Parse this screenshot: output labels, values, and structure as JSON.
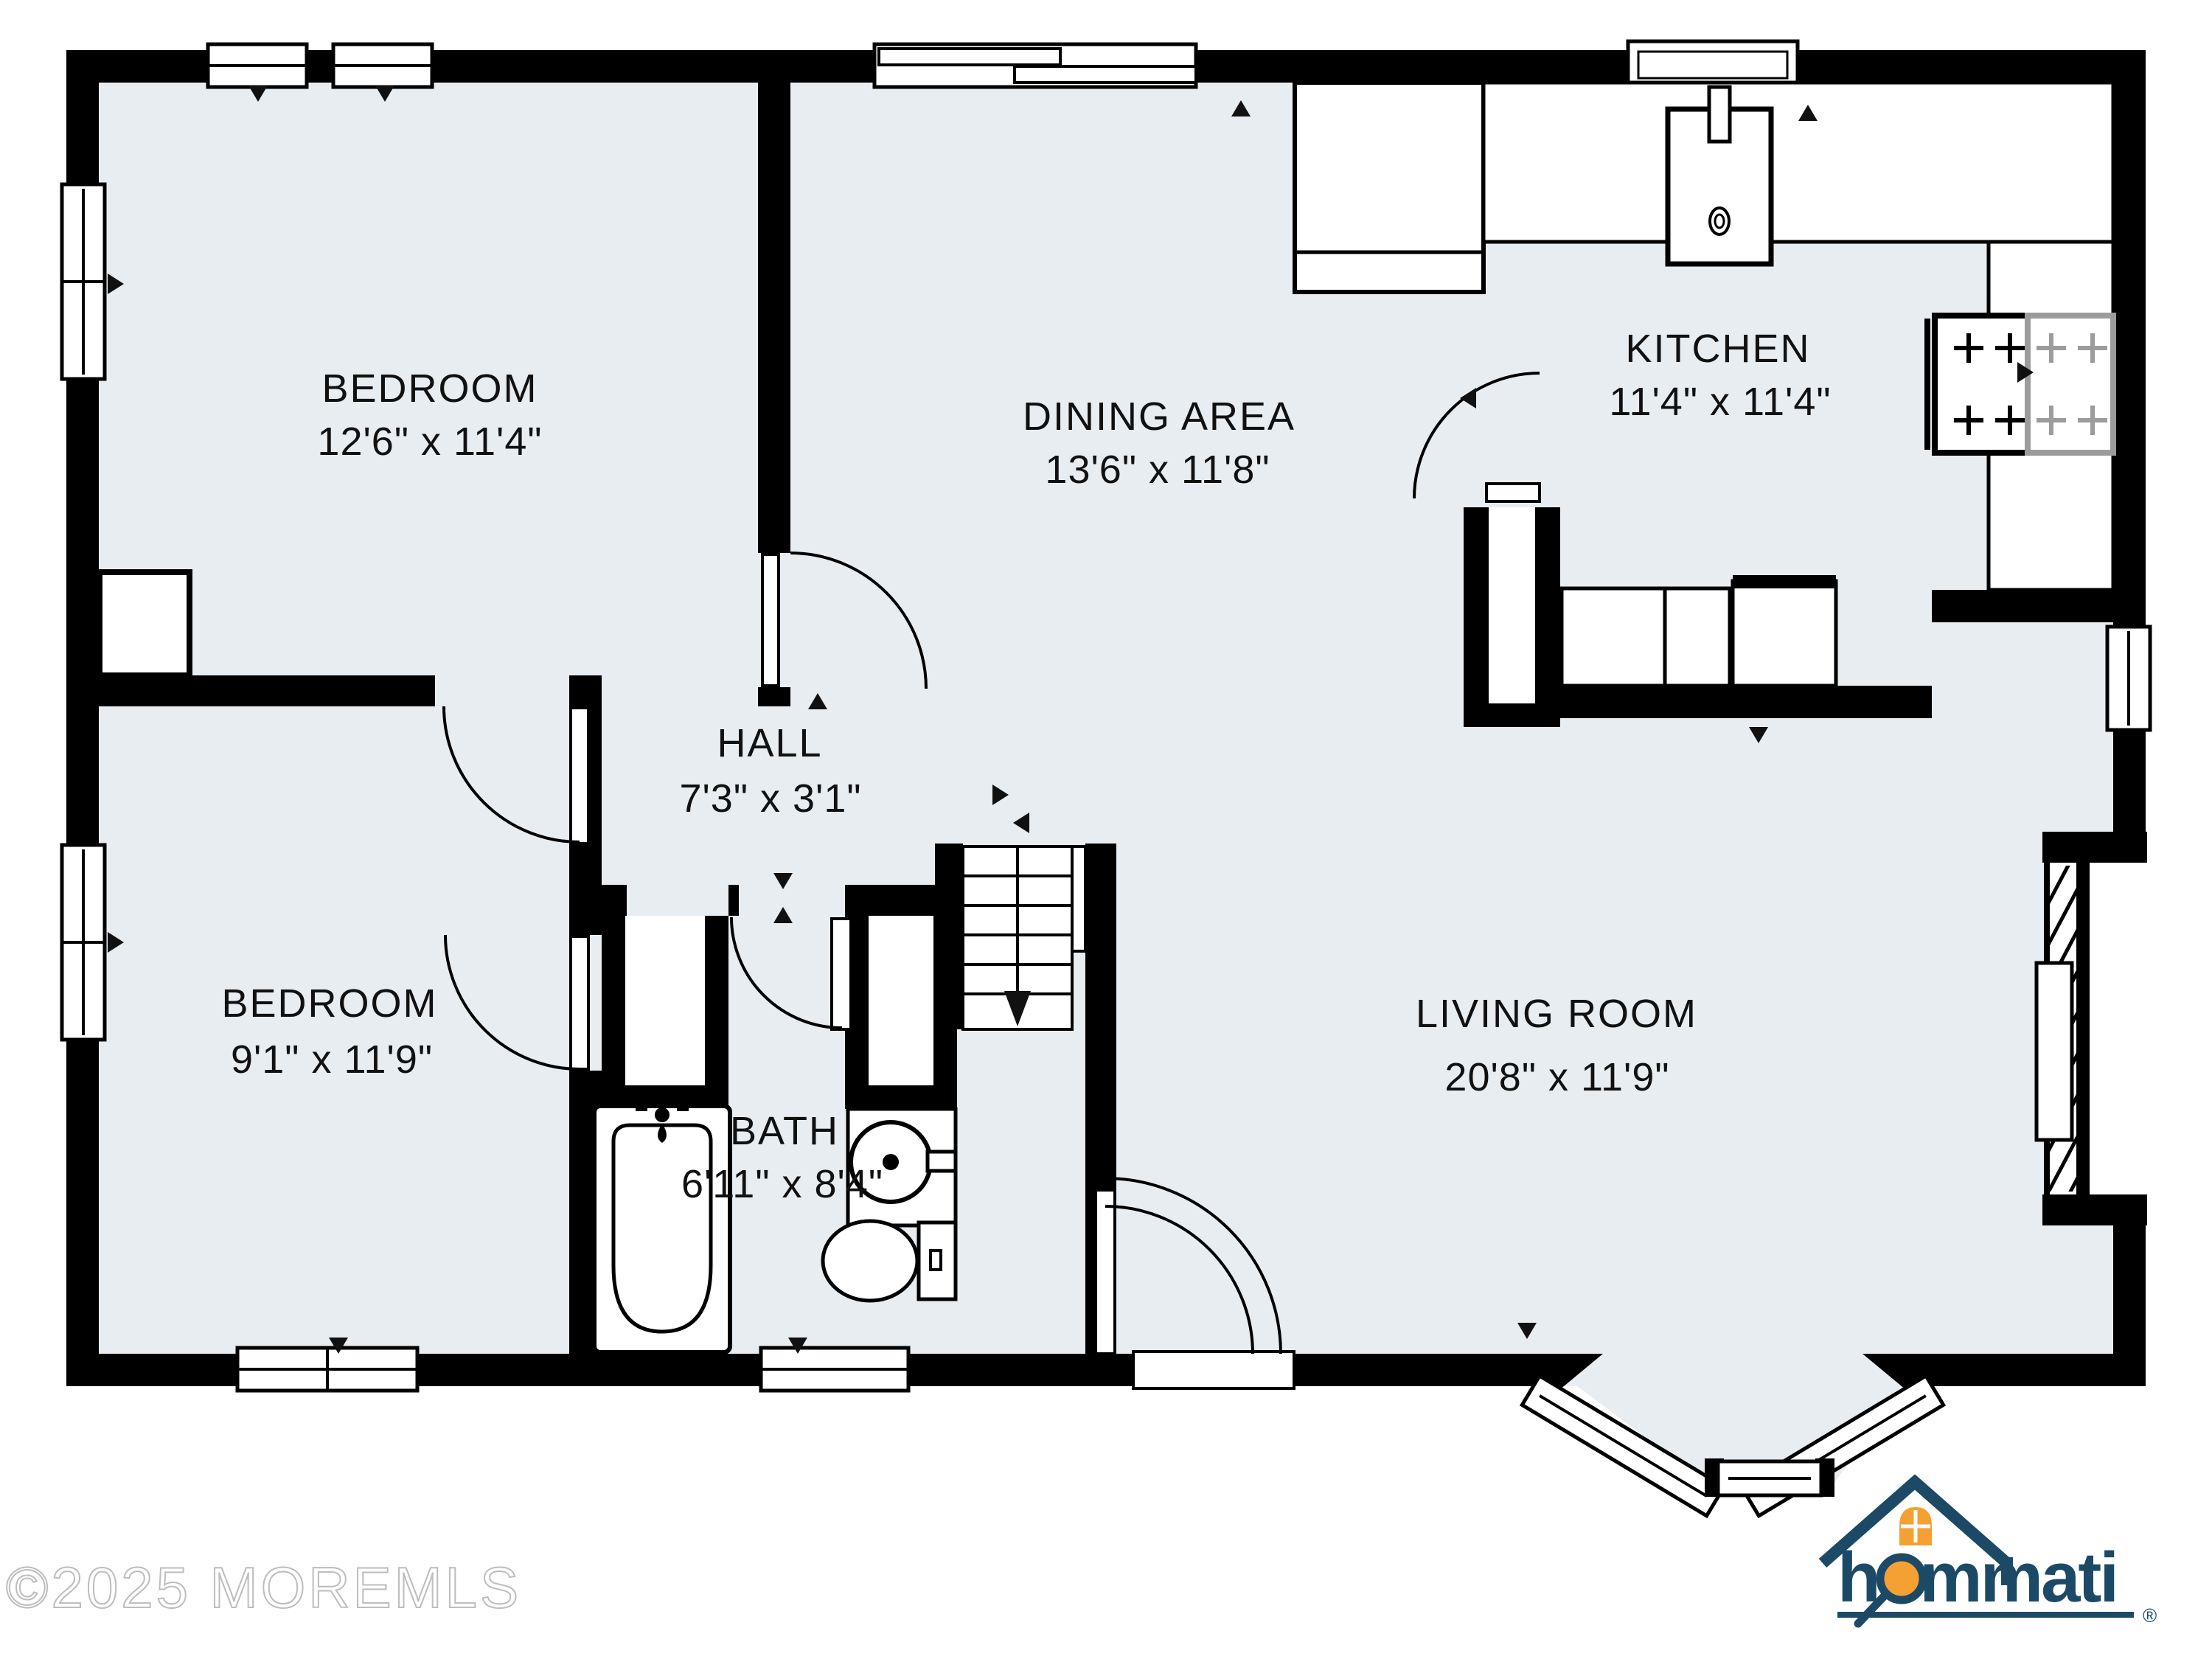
{
  "colors": {
    "floor": "#e8edf1",
    "wall": "#000000",
    "counter_white": "#ffffff",
    "logo_navy": "#1c4a66",
    "logo_orange": "#f5a033",
    "watermark_gray": "#bdbdbd",
    "stove_gray": "#9c9c9c"
  },
  "rooms": [
    {
      "id": "bedroom-1",
      "name": "BEDROOM",
      "dims": "12'6\" x 11'4\""
    },
    {
      "id": "dining-area",
      "name": "DINING AREA",
      "dims": "13'6\" x 11'8\""
    },
    {
      "id": "kitchen",
      "name": "KITCHEN",
      "dims": "11'4\" x 11'4\""
    },
    {
      "id": "hall",
      "name": "HALL",
      "dims": "7'3\" x 3'1\""
    },
    {
      "id": "bedroom-2",
      "name": "BEDROOM",
      "dims": "9'1\" x 11'9\""
    },
    {
      "id": "bath",
      "name": "BATH",
      "dims": "6'11\" x 8'4\""
    },
    {
      "id": "living-room",
      "name": "LIVING ROOM",
      "dims": "20'8\" x 11'9\""
    }
  ],
  "fixtures": [
    "bathtub",
    "toilet",
    "vanity-sink",
    "kitchen-sink",
    "range-stove",
    "refrigerator",
    "kitchen-counter",
    "kitchen-peninsula",
    "pantry-closet",
    "staircase",
    "fireplace",
    "bay-window",
    "sliding-glass-door",
    "front-door",
    "closet",
    "windows"
  ],
  "watermark": "©2025 MOREMLS",
  "logo": {
    "text": "hommati",
    "registered": "®"
  }
}
